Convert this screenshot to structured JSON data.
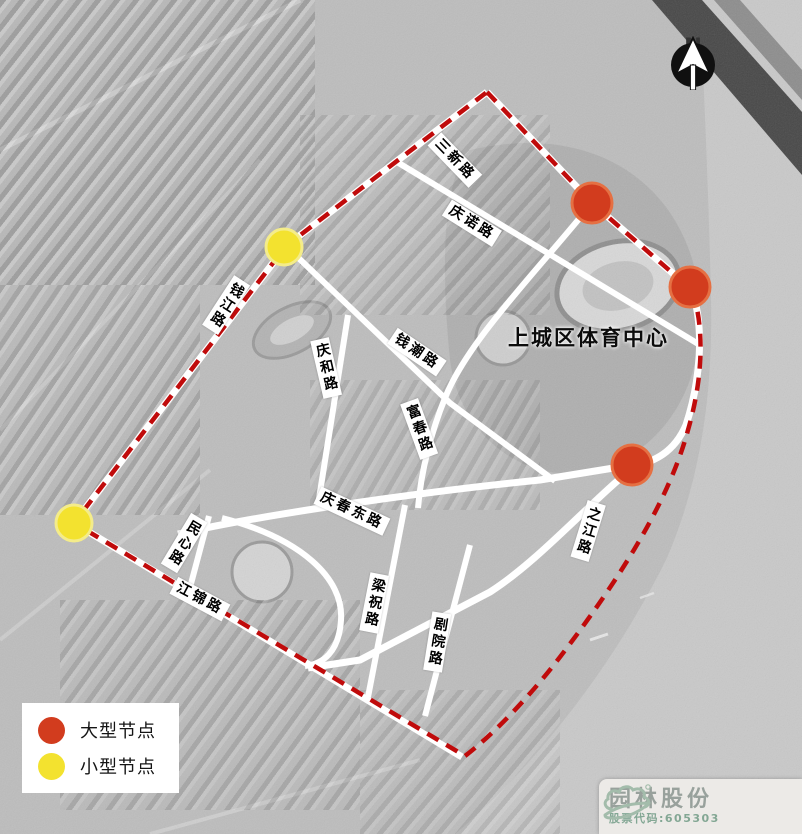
{
  "map": {
    "site_label": "上城区体育中心",
    "colors": {
      "road": "#ffffff",
      "boundary": "#c00b0b",
      "large_node_fill": "#d23c1e",
      "large_node_stroke": "#e57043",
      "small_node_fill": "#f3e22f",
      "small_node_stroke": "#f4ec8a"
    },
    "boundary": {
      "d": "M487,92 L592,203 L692,290 C704,325 704,375 688,430 C670,497 625,572 560,657 C531,695 495,733 465,756 L74,523 L286,246 Z"
    },
    "roads": [
      {
        "name": "qianjiang-road",
        "d": "M487,92 L286,246 L74,523",
        "w": 7
      },
      {
        "name": "sanxin-road",
        "d": "M487,92 L592,203 L692,290",
        "w": 7
      },
      {
        "name": "riverside-zhijiang-road",
        "d": "M692,290 C705,330 700,382 686,425 C674,453 654,461 634,467 C592,500 540,560 490,592 L360,660 L308,668",
        "w": 7
      },
      {
        "name": "jiangjin-road",
        "d": "M74,523 L462,757",
        "w": 7
      },
      {
        "name": "qingnuo-road",
        "d": "M397,162 L700,345",
        "w": 6
      },
      {
        "name": "qianchao-road",
        "d": "M286,246 L450,403 L555,481",
        "w": 6
      },
      {
        "name": "qinghe-road",
        "d": "M348,315 L318,505",
        "w": 6
      },
      {
        "name": "fuchun-road",
        "d": "M592,203 C540,268 468,340 445,398 C432,430 421,470 418,508",
        "w": 6
      },
      {
        "name": "qingchun-east-road",
        "d": "M178,534 C260,515 420,492 540,480 L632,465",
        "w": 7
      },
      {
        "name": "minxin-road",
        "d": "M209,516 L188,595",
        "w": 6
      },
      {
        "name": "liangzhu-road",
        "d": "M405,505 L368,697",
        "w": 6
      },
      {
        "name": "juyuan-road",
        "d": "M470,545 L425,716",
        "w": 6
      },
      {
        "name": "theater-loop-road",
        "d": "M222,518 C300,538 344,578 341,620 C339,652 323,664 305,666",
        "w": 6
      }
    ],
    "nodes": [
      {
        "type": "large",
        "x": 592,
        "y": 203
      },
      {
        "type": "large",
        "x": 690,
        "y": 287
      },
      {
        "type": "large",
        "x": 632,
        "y": 465
      },
      {
        "type": "small",
        "x": 284,
        "y": 247
      },
      {
        "type": "small",
        "x": 74,
        "y": 523
      }
    ],
    "road_labels": [
      {
        "text": "三新路",
        "x": 455,
        "y": 160,
        "rot": 46,
        "dir": "row"
      },
      {
        "text": "庆诺路",
        "x": 472,
        "y": 223,
        "rot": 32,
        "dir": "row"
      },
      {
        "text": "钱江路",
        "x": 226,
        "y": 305,
        "rot": 33,
        "dir": "col"
      },
      {
        "text": "钱潮路",
        "x": 417,
        "y": 352,
        "rot": 34,
        "dir": "row"
      },
      {
        "text": "庆和路",
        "x": 326,
        "y": 368,
        "rot": -13,
        "dir": "col"
      },
      {
        "text": "富春路",
        "x": 419,
        "y": 429,
        "rot": -20,
        "dir": "col"
      },
      {
        "text": "庆春东路",
        "x": 352,
        "y": 511,
        "rot": 25,
        "dir": "row"
      },
      {
        "text": "之江路",
        "x": 588,
        "y": 531,
        "rot": 17,
        "dir": "col"
      },
      {
        "text": "民心路",
        "x": 184,
        "y": 543,
        "rot": 31,
        "dir": "col"
      },
      {
        "text": "江锦路",
        "x": 200,
        "y": 599,
        "rot": 28,
        "dir": "row"
      },
      {
        "text": "梁祝路",
        "x": 374,
        "y": 603,
        "rot": 11,
        "dir": "col"
      },
      {
        "text": "剧院路",
        "x": 437,
        "y": 642,
        "rot": 9,
        "dir": "col"
      }
    ]
  },
  "legend": {
    "items": [
      {
        "id": "large",
        "label": "大型节点",
        "color": "#d23c1e"
      },
      {
        "id": "small",
        "label": "小型节点",
        "color": "#f3e22f"
      }
    ]
  },
  "compass": {
    "label": "N"
  },
  "logo": {
    "company": "园林股份",
    "stock_code": "股票代码:605303"
  }
}
